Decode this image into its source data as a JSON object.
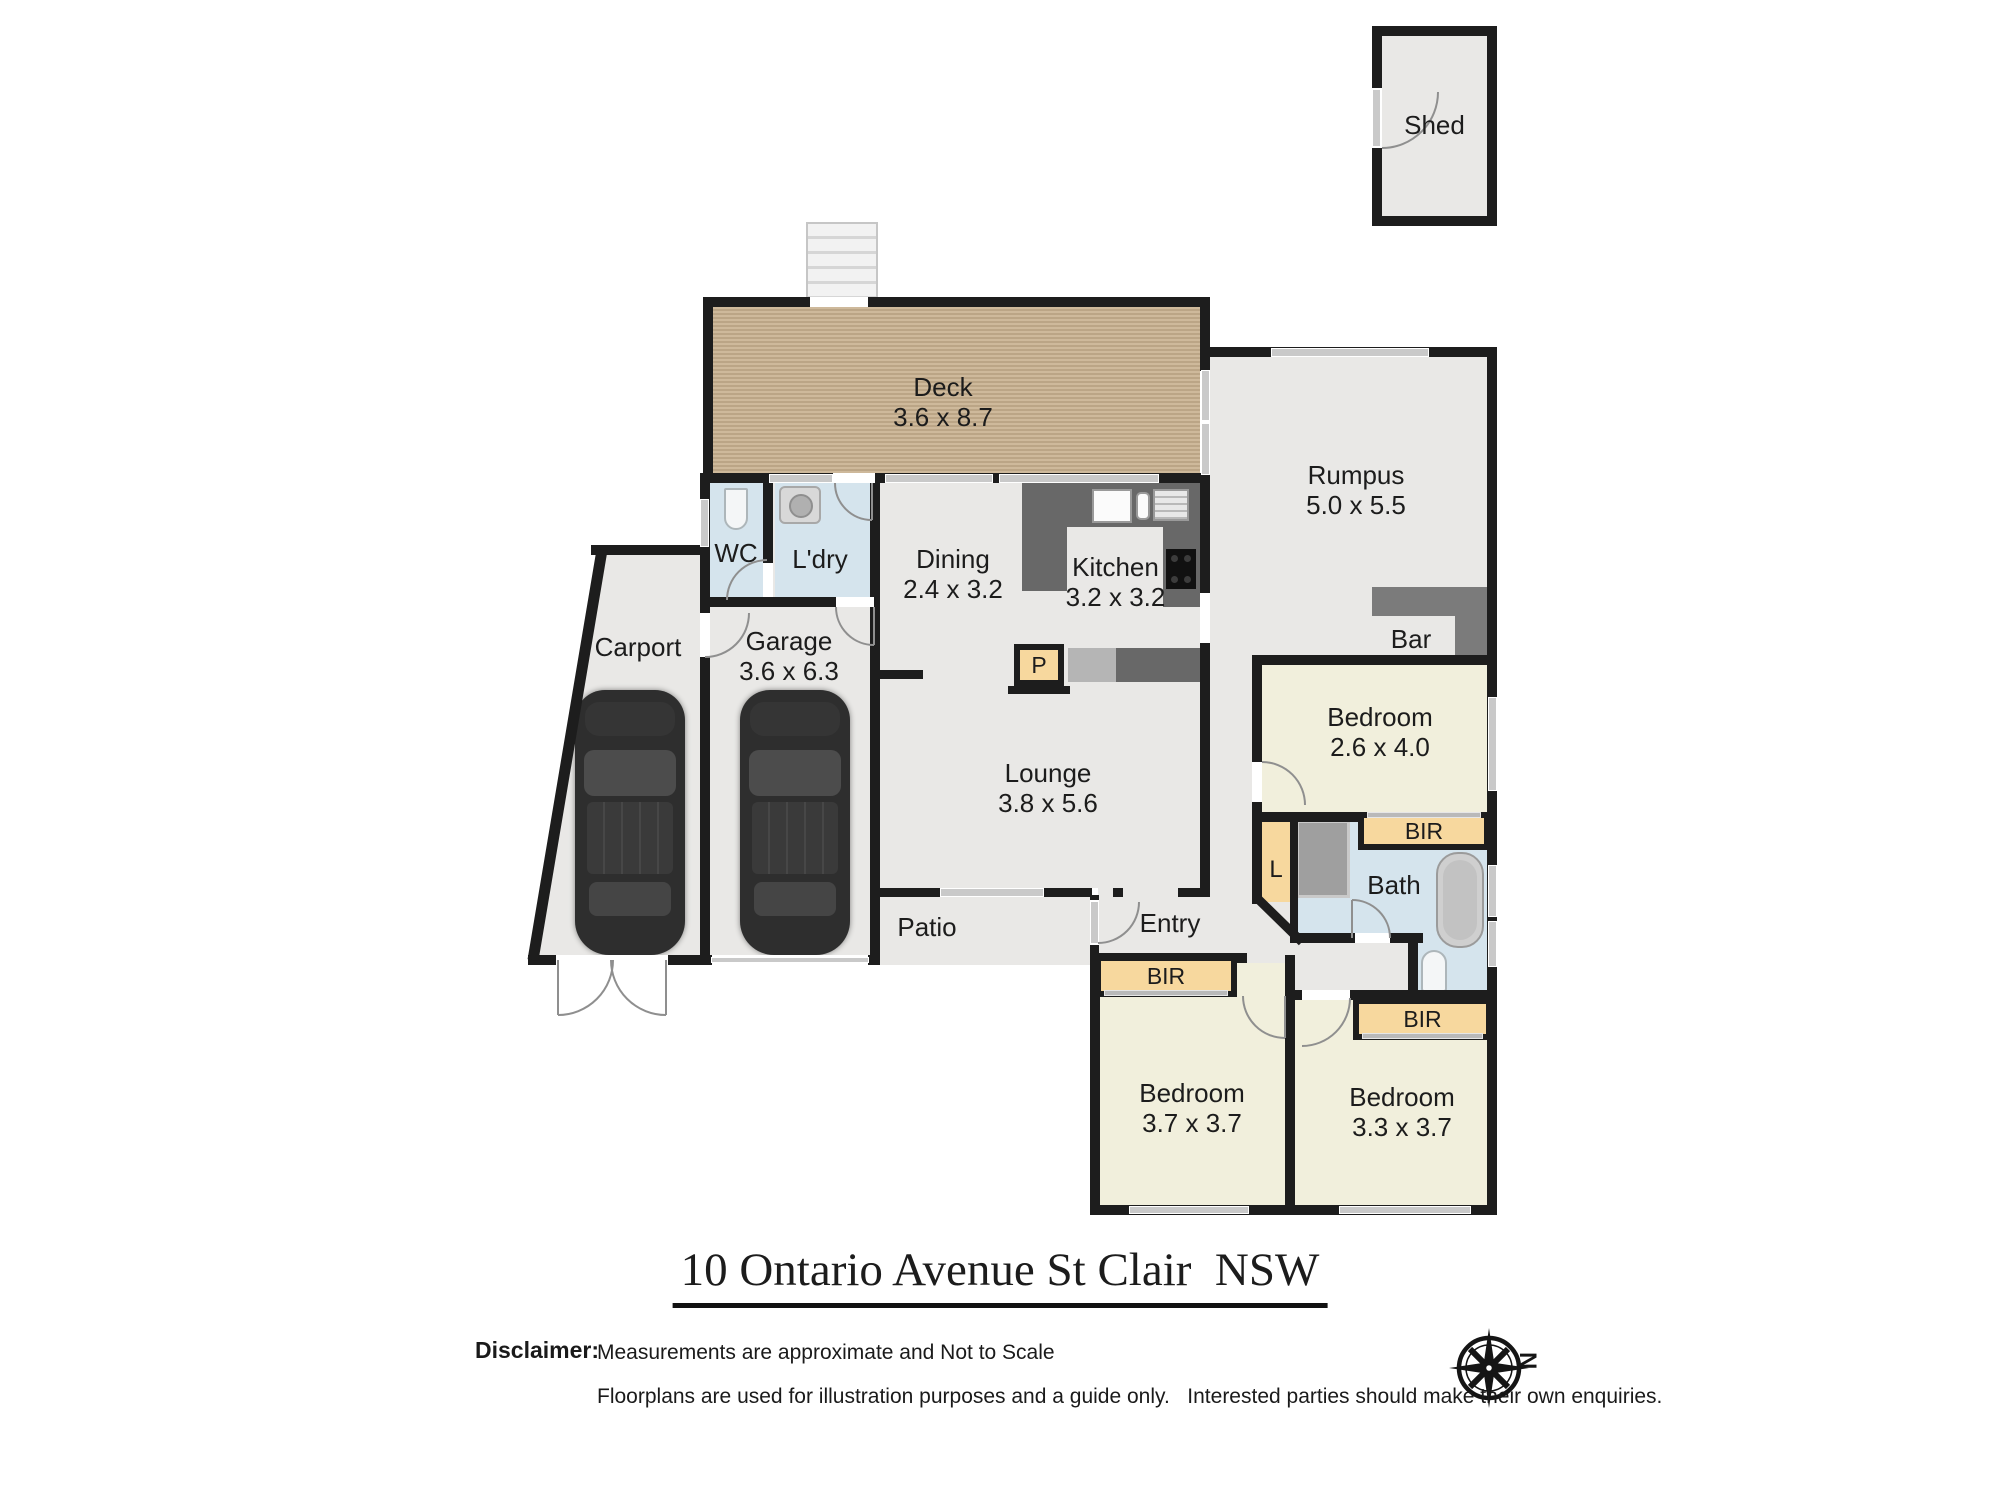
{
  "meta": {
    "title": "10 Ontario Avenue St Clair  NSW"
  },
  "compass": {
    "north_label": "N"
  },
  "disclaimer": {
    "heading": "Disclaimer:",
    "line1": "Measurements are approximate and Not to Scale",
    "line2": "Floorplans are used for illustration purposes and a guide only.   Interested parties should make their own enquiries."
  },
  "rooms": {
    "shed": {
      "name": "Shed"
    },
    "deck": {
      "name": "Deck",
      "dims": "3.6 x 8.7"
    },
    "rumpus": {
      "name": "Rumpus",
      "dims": "5.0 x 5.5"
    },
    "wc": {
      "name": "WC"
    },
    "laundry": {
      "name": "L'dry"
    },
    "dining": {
      "name": "Dining",
      "dims": "2.4 x 3.2"
    },
    "kitchen": {
      "name": "Kitchen",
      "dims": "3.2 x 3.2"
    },
    "bar": {
      "name": "Bar"
    },
    "carport": {
      "name": "Carport"
    },
    "garage": {
      "name": "Garage",
      "dims": "3.6 x 6.3"
    },
    "lounge": {
      "name": "Lounge",
      "dims": "3.8 x 5.6"
    },
    "patio": {
      "name": "Patio"
    },
    "entry": {
      "name": "Entry"
    },
    "bath": {
      "name": "Bath"
    },
    "bedroom1": {
      "name": "Bedroom",
      "dims": "2.6 x 4.0"
    },
    "bedroom2": {
      "name": "Bedroom",
      "dims": "3.7 x 3.7"
    },
    "bedroom3": {
      "name": "Bedroom",
      "dims": "3.3 x 3.7"
    }
  },
  "closets": {
    "bir1": "BIR",
    "bir2": "BIR",
    "bir3": "BIR",
    "linen": "L",
    "pantry": "P"
  },
  "colors": {
    "wall": "#1d1d1d",
    "floor": "#e9e8e6",
    "wet_room": "#d5e4ed",
    "bedroom": "#f1efdc",
    "robe": "#f7d89e",
    "deck": "#c9b190",
    "counter": "#686868",
    "bar": "#7b7b7b",
    "window": "#c9c9c9"
  }
}
